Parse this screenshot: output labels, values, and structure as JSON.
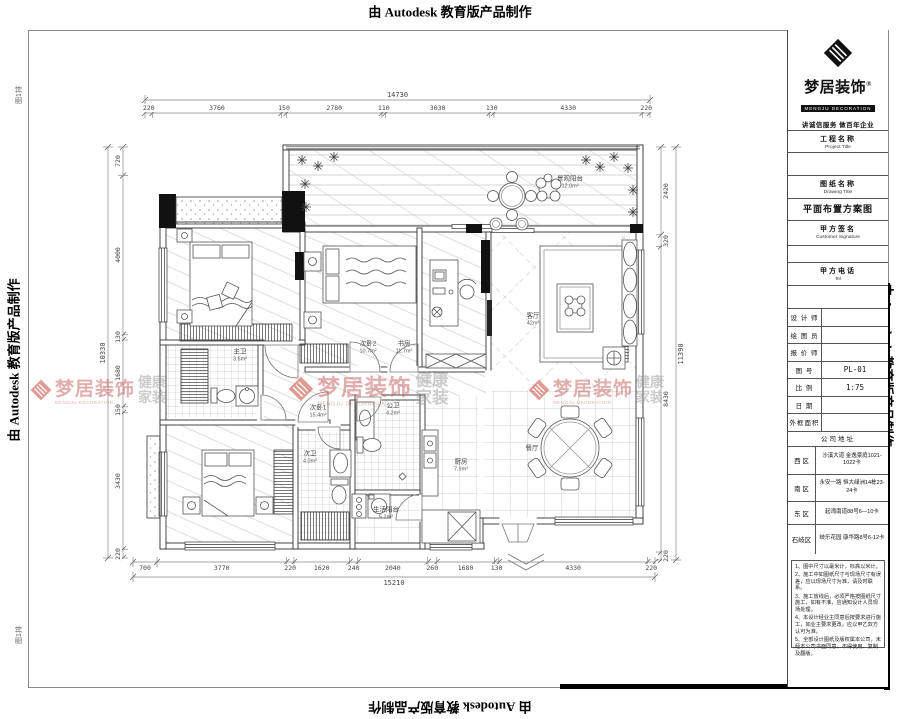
{
  "banner": {
    "text": "由 Autodesk 教育版产品制作"
  },
  "corner_stamp": "图1排",
  "watermark": {
    "brand": "梦居装饰",
    "brand_en": "MENGJU DECORATION",
    "tagline": "健康家装"
  },
  "title_block": {
    "brand": {
      "name": "梦居装饰",
      "reg": "®",
      "name_en": "MENGJU DECORATION",
      "slogan": "讲诚信服务  做百年企业"
    },
    "sections": {
      "project": {
        "zh": "工程名称",
        "en": "Project Title",
        "value": ""
      },
      "drawing": {
        "zh": "图纸名称",
        "en": "Drawing Title",
        "value": "平面布置方案图"
      },
      "signature": {
        "zh": "甲方签名",
        "en": "Customer Signature",
        "value": ""
      },
      "tel": {
        "zh": "甲方电话",
        "en": "Tel",
        "value": ""
      }
    },
    "info_rows": [
      {
        "label": "设 计 师",
        "value": ""
      },
      {
        "label": "绘 图 员",
        "value": ""
      },
      {
        "label": "报 价 师",
        "value": ""
      },
      {
        "label": "图    号",
        "value": "PL-01"
      },
      {
        "label": "比    例",
        "value": "1:75"
      },
      {
        "label": "日    期",
        "value": ""
      },
      {
        "label": "外框面积",
        "value": ""
      }
    ],
    "address_header": "公司地址",
    "addresses": [
      {
        "district": "西  区",
        "detail": "沙溪大道 金逸豪庭1021-1022卡"
      },
      {
        "district": "南  区",
        "detail": "永安一路 恒大绿洲14栋23-24卡"
      },
      {
        "district": "东  区",
        "detail": "起湾南道88号6—10卡"
      },
      {
        "district": "石岐区",
        "detail": "岐乐花园 康华路8号6-12卡"
      }
    ],
    "notes": [
      "1、图中尺寸以毫米计，标高以米计。",
      "2、施工中如图纸尺寸与现场尺寸有误差，应以现场尺寸为准，请及时联系。",
      "3、施工放线后，必须严格按图纸尺寸施工，如有不准，应通知设计人员现场处理。",
      "4、本设计经业主同意后按要求进行施工，如业主要求更改，应以甲乙双方认可为准。",
      "5、全部设计图纸及版权属本公司，未经本公司书面同意，不得使用、复制及翻版。"
    ]
  },
  "plan": {
    "rooms": [
      {
        "name": "景观阳台",
        "area": "12.0m²"
      },
      {
        "name": "主卫",
        "area": "3.6m²"
      },
      {
        "name": "次卧2",
        "area": "10.7m²"
      },
      {
        "name": "书房",
        "area": "11.7m²"
      },
      {
        "name": "客厅",
        "area": "42m²"
      },
      {
        "name": "餐厅",
        "area": ""
      },
      {
        "name": "公卫",
        "area": "4.2m²"
      },
      {
        "name": "次卧1",
        "area": "15.4m²"
      },
      {
        "name": "次卫",
        "area": "4.0m²"
      },
      {
        "name": "生活阳台",
        "area": "5.2m²"
      },
      {
        "name": "厨房",
        "area": "7.9m²"
      }
    ],
    "dims": {
      "top": {
        "total": "14730",
        "segments": [
          "220",
          "3760",
          "150",
          "2780",
          "110",
          "3030",
          "130",
          "4330",
          "220"
        ]
      },
      "bottom": {
        "total": "15210",
        "segments": [
          "700",
          "3770",
          "220",
          "1620",
          "240",
          "2040",
          "260",
          "1680",
          "130",
          "4330",
          "220"
        ]
      },
      "left": {
        "total": "10330",
        "segments": [
          "720",
          "4000",
          "130",
          "1680",
          "150",
          "3430",
          "220"
        ]
      },
      "right": {
        "total": "11390",
        "segments": [
          "2420",
          "320",
          "8430",
          "220"
        ]
      }
    }
  }
}
